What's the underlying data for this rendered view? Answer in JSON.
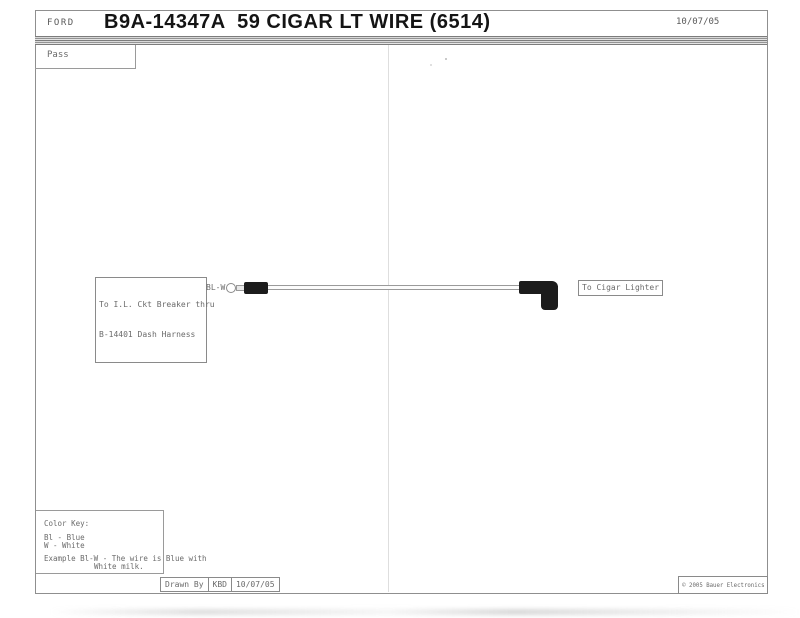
{
  "header": {
    "brand": "FORD",
    "title": "B9A-14347A  59 CIGAR LT WIRE (6514)",
    "date": "10/07/05"
  },
  "pass_label": "Pass",
  "diagram": {
    "left_label_line1": "To I.L. Ckt Breaker thru",
    "left_label_line2": "B-14401 Dash Harness",
    "wire_code": "BL-W",
    "right_label": "To Cigar Lighter"
  },
  "color_key": {
    "title": "Color Key:",
    "entries": [
      "Bl - Blue",
      "W - White"
    ],
    "example_line1": "Example Bl-W - The wire is Blue with",
    "example_line2": "White milk."
  },
  "footer": {
    "drawn_by_label": "Drawn By",
    "drawn_by_value": "KBD",
    "date": "10/07/05",
    "copyright": "© 2005 Bauer Electronics"
  },
  "colors": {
    "frame_line": "#8f8f8f",
    "text": "#6b6b6b",
    "title_text": "#141414",
    "connector": "#1c1c1c",
    "fold_line": "#dedede"
  }
}
